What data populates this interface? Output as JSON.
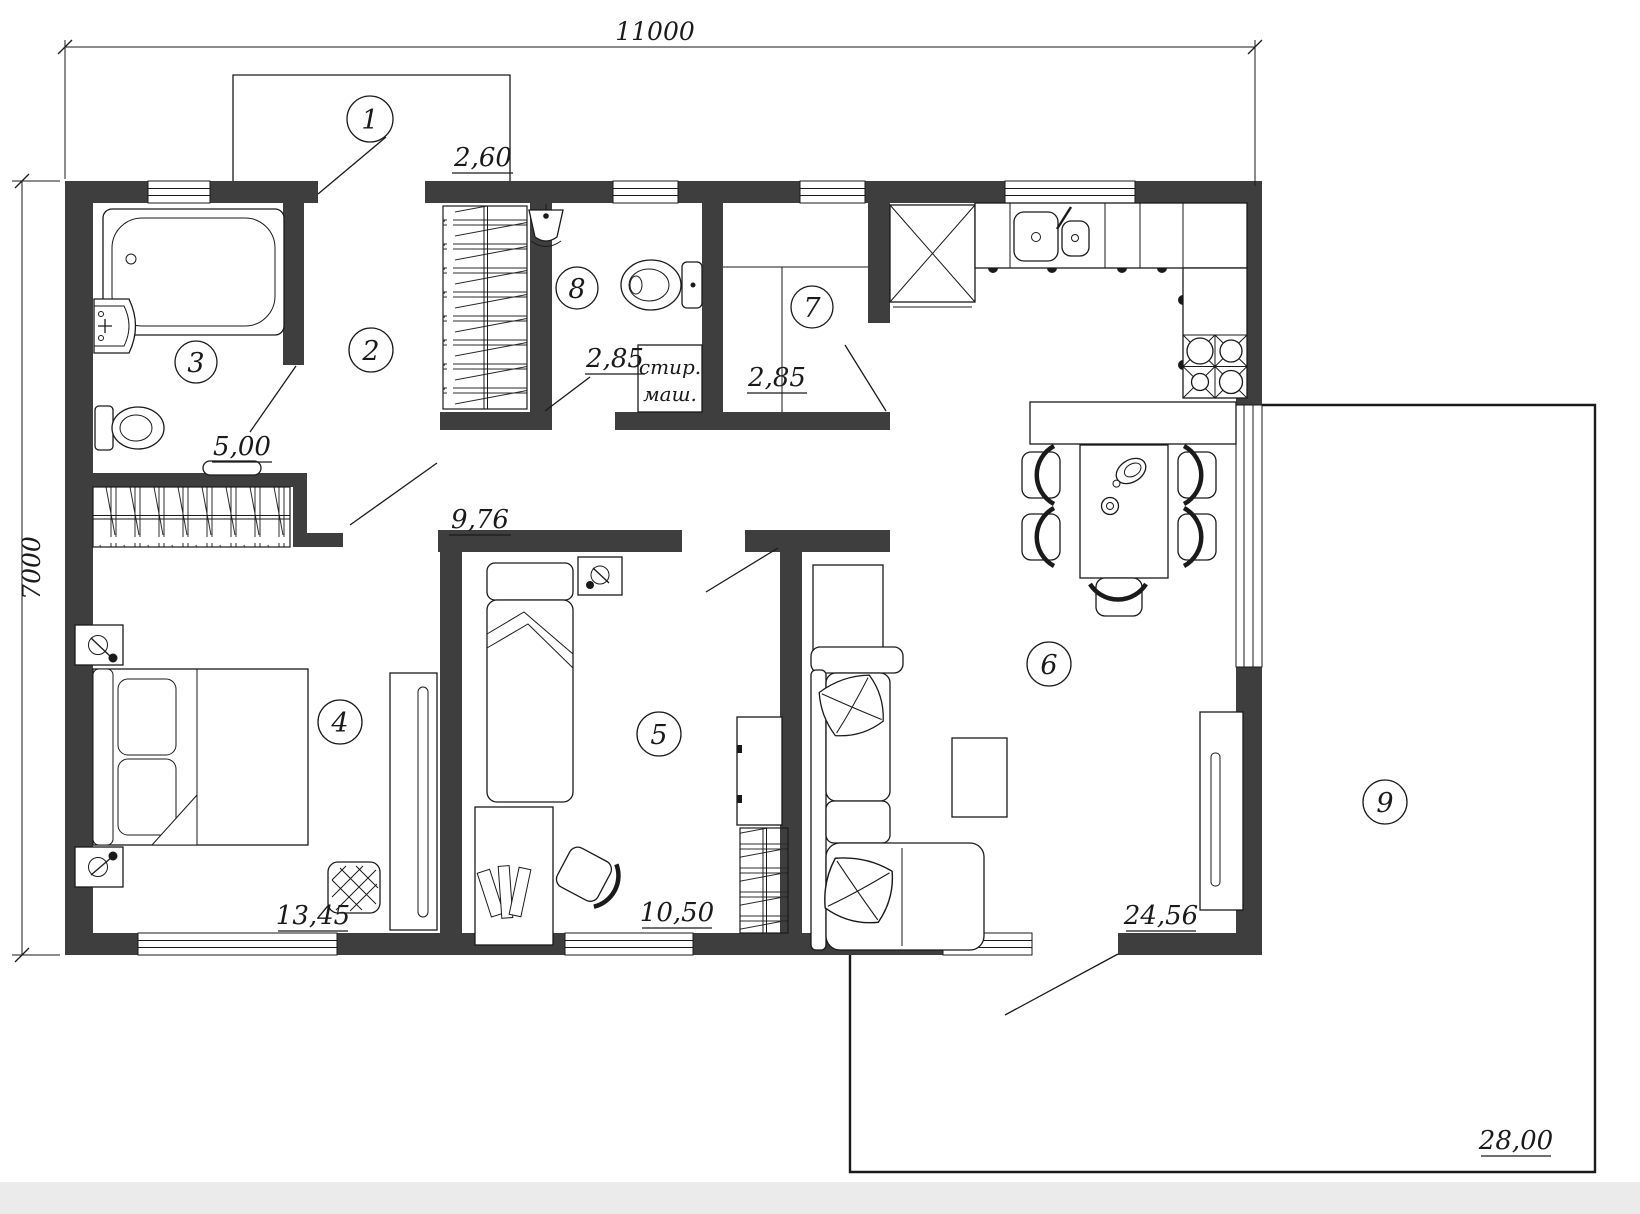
{
  "plan": {
    "dimensions": {
      "top": "11000",
      "left": "7000"
    },
    "rooms": [
      {
        "number": "1",
        "area": ""
      },
      {
        "number": "2",
        "area": "9,76"
      },
      {
        "number": "3",
        "area": "5,00"
      },
      {
        "number": "4",
        "area": "13,45"
      },
      {
        "number": "5",
        "area": "10,50"
      },
      {
        "number": "6",
        "area": "24,56"
      },
      {
        "number": "7",
        "area": "2,85"
      },
      {
        "number": "8",
        "area": "2,85"
      },
      {
        "number": "9",
        "area": "28,00"
      }
    ],
    "closet_area": "2,60",
    "washer": {
      "line1": "стир.",
      "line2": "маш."
    },
    "colors": {
      "wall": "#3e3e3e",
      "line": "#1a1a1a",
      "bg": "#ffffff",
      "strip": "#ebebeb"
    }
  }
}
